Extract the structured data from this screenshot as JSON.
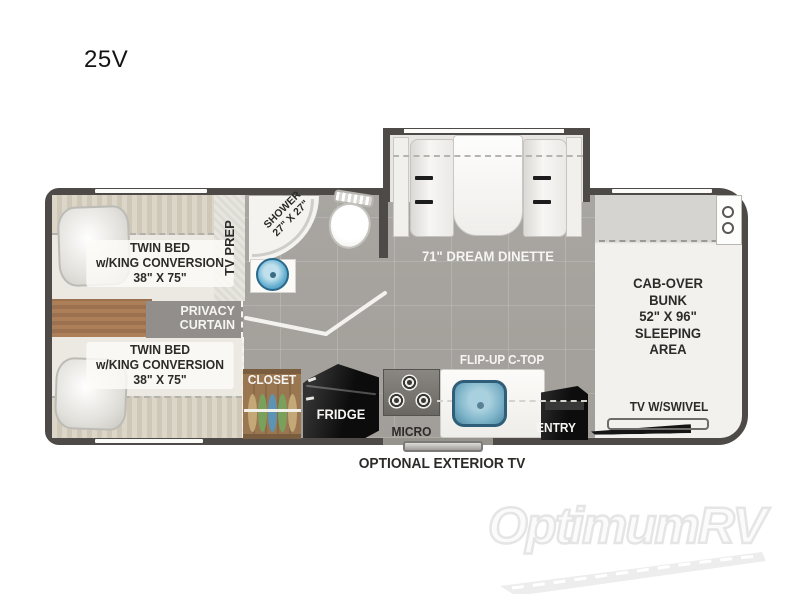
{
  "page": {
    "title": "25V"
  },
  "floorplan": {
    "bedroom": {
      "bed_top_label": "TWIN BED\nw/KING CONVERSION\n38\" X 75\"",
      "bed_bottom_label": "TWIN BED\nw/KING CONVERSION\n38\" X 75\"",
      "tv_prep_label": "TV PREP",
      "privacy_curtain_label": "PRIVACY\nCURTAIN"
    },
    "bathroom": {
      "shower_label": "SHOWER\n27\" X 27\""
    },
    "dinette": {
      "label": "71\" DREAM DINETTE"
    },
    "bunk": {
      "label": "CAB-OVER\nBUNK\n52\" X 96\"\nSLEEPING\nAREA",
      "tv_label": "TV W/SWIVEL"
    },
    "kitchen": {
      "closet_label": "CLOSET",
      "fridge_label": "FRIDGE",
      "micro_label": "MICRO",
      "flip_up_label": "FLIP-UP C-TOP",
      "entry_label": "ENTRY"
    },
    "exterior": {
      "tv_label": "OPTIONAL EXTERIOR TV"
    }
  },
  "watermark": {
    "brand": "OptimumRV"
  },
  "colors": {
    "wall": "#4d4a47",
    "floor": "#a7a49f",
    "bed_linen": "#ece9e2",
    "wood": "#a87f58",
    "sink_blue": "#4a9ec4",
    "fridge_black": "#111111",
    "hanger_green": "#79a15c",
    "hanger_blue": "#5d94b4",
    "hanger_tan": "#c4a878",
    "label_dark": "#2d2b29",
    "watermark_gray": "#e5e5e5"
  }
}
